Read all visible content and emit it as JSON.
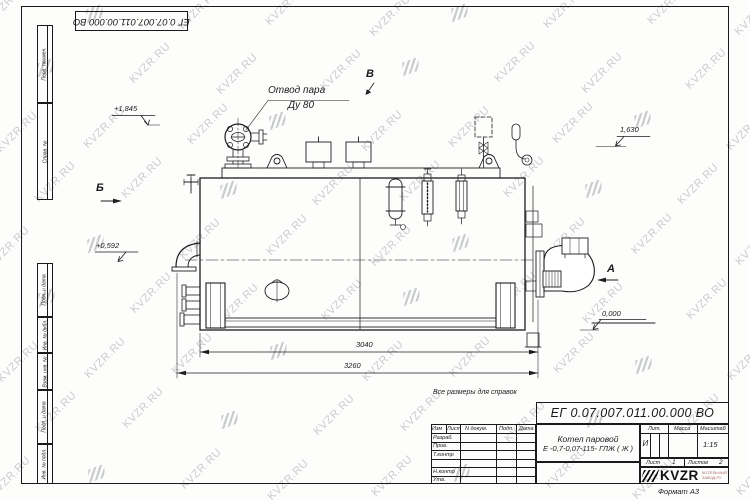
{
  "watermark": {
    "text": "KVZR.RU"
  },
  "corner": {
    "designation": "ЕГ 0.07.007.011.00.000  ВО"
  },
  "margin": {
    "labels": [
      "Перв. примен.",
      "Справ. №",
      "Подп. и дата",
      "Инв. № дубл.",
      "Взам. инв. №",
      "Подп. и дата",
      "Инв. № подл."
    ]
  },
  "labels": {
    "steam_line1": "Отвод пара",
    "steam_line2": "Ду 80",
    "elev_top_left": "+1,845",
    "elev_top_right": "1,630",
    "elev_mid_left": "+0,592",
    "elev_zero": "0,000",
    "view_b": "Б",
    "view_v": "В",
    "view_a": "А",
    "dim_inner": "3040",
    "dim_outer": "3260",
    "note": "Все размеры для справок"
  },
  "title_block": {
    "designation": "ЕГ 0.07.007.011.00.000  ВО",
    "name_line1": "Котел паровой",
    "name_line2": "Е -0,7-0,07-115- ГЛЖ ( Ж )",
    "col_izm": "Изм",
    "col_list": "Лист",
    "col_docnum": "N докум.",
    "col_podp": "Подп.",
    "col_data": "Дата",
    "row_razrab": "Разраб.",
    "row_prov": "Пров.",
    "row_tkontr": "Т.контр",
    "row_nkontr": "Н.контр",
    "row_utv": "Утв.",
    "lit_header": "Лит.",
    "mass_header": "Масса",
    "scale_header": "Масштаб",
    "lit_value": "И",
    "scale_value": "1:15",
    "sheet_label": "Лист",
    "sheet_value": "1",
    "sheets_label": "Листов",
    "sheets_value": "2",
    "logo_text": "KVZR",
    "logo_sub1": "КОТЕЛЬНЫЙ",
    "logo_sub2": "ЗАВОД.РУ",
    "format_label": "Формат А3"
  }
}
